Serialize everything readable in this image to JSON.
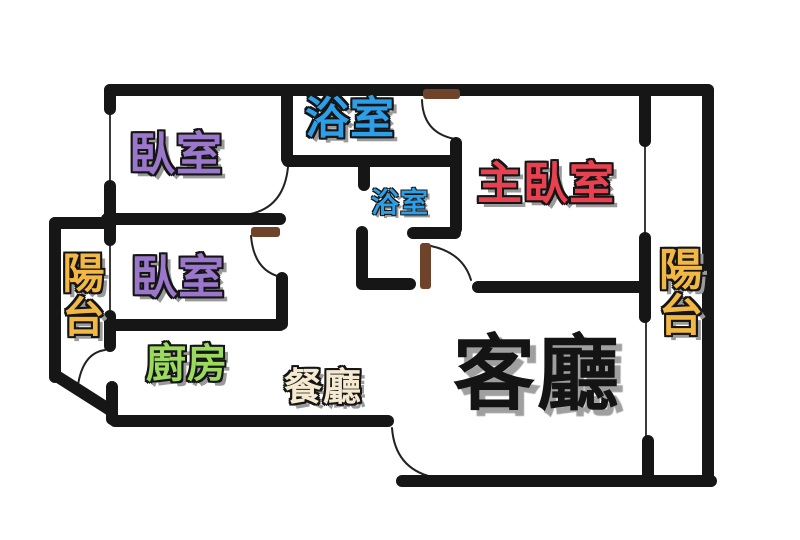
{
  "plan": {
    "background_color": "#ffffff",
    "wall_color": "#161616",
    "window_line_color": "#3a3a3a",
    "door_color": "#6e432a",
    "arc_color": "#222222",
    "label_outline_color": "#151515",
    "label_shadow_color": "#9a9a9a"
  },
  "rooms": {
    "bedroom_top": {
      "label": "臥室",
      "color": "#9a77cb"
    },
    "bathroom_main": {
      "label": "浴室",
      "color": "#2d9fe8"
    },
    "master_bedroom": {
      "label": "主臥室",
      "color": "#ea4150"
    },
    "bathroom_small": {
      "label": "浴室",
      "color": "#2d9fe8"
    },
    "bedroom_mid": {
      "label": "臥室",
      "color": "#9a77cb"
    },
    "balcony_left": {
      "label": "陽台",
      "color": "#f2b843"
    },
    "balcony_right": {
      "label": "陽台",
      "color": "#f2b843"
    },
    "kitchen": {
      "label": "廚房",
      "color": "#9cd95f"
    },
    "dining": {
      "label": "餐廳",
      "color": "#f5ead0"
    },
    "living": {
      "label": "客廳",
      "color": "#141414"
    }
  }
}
